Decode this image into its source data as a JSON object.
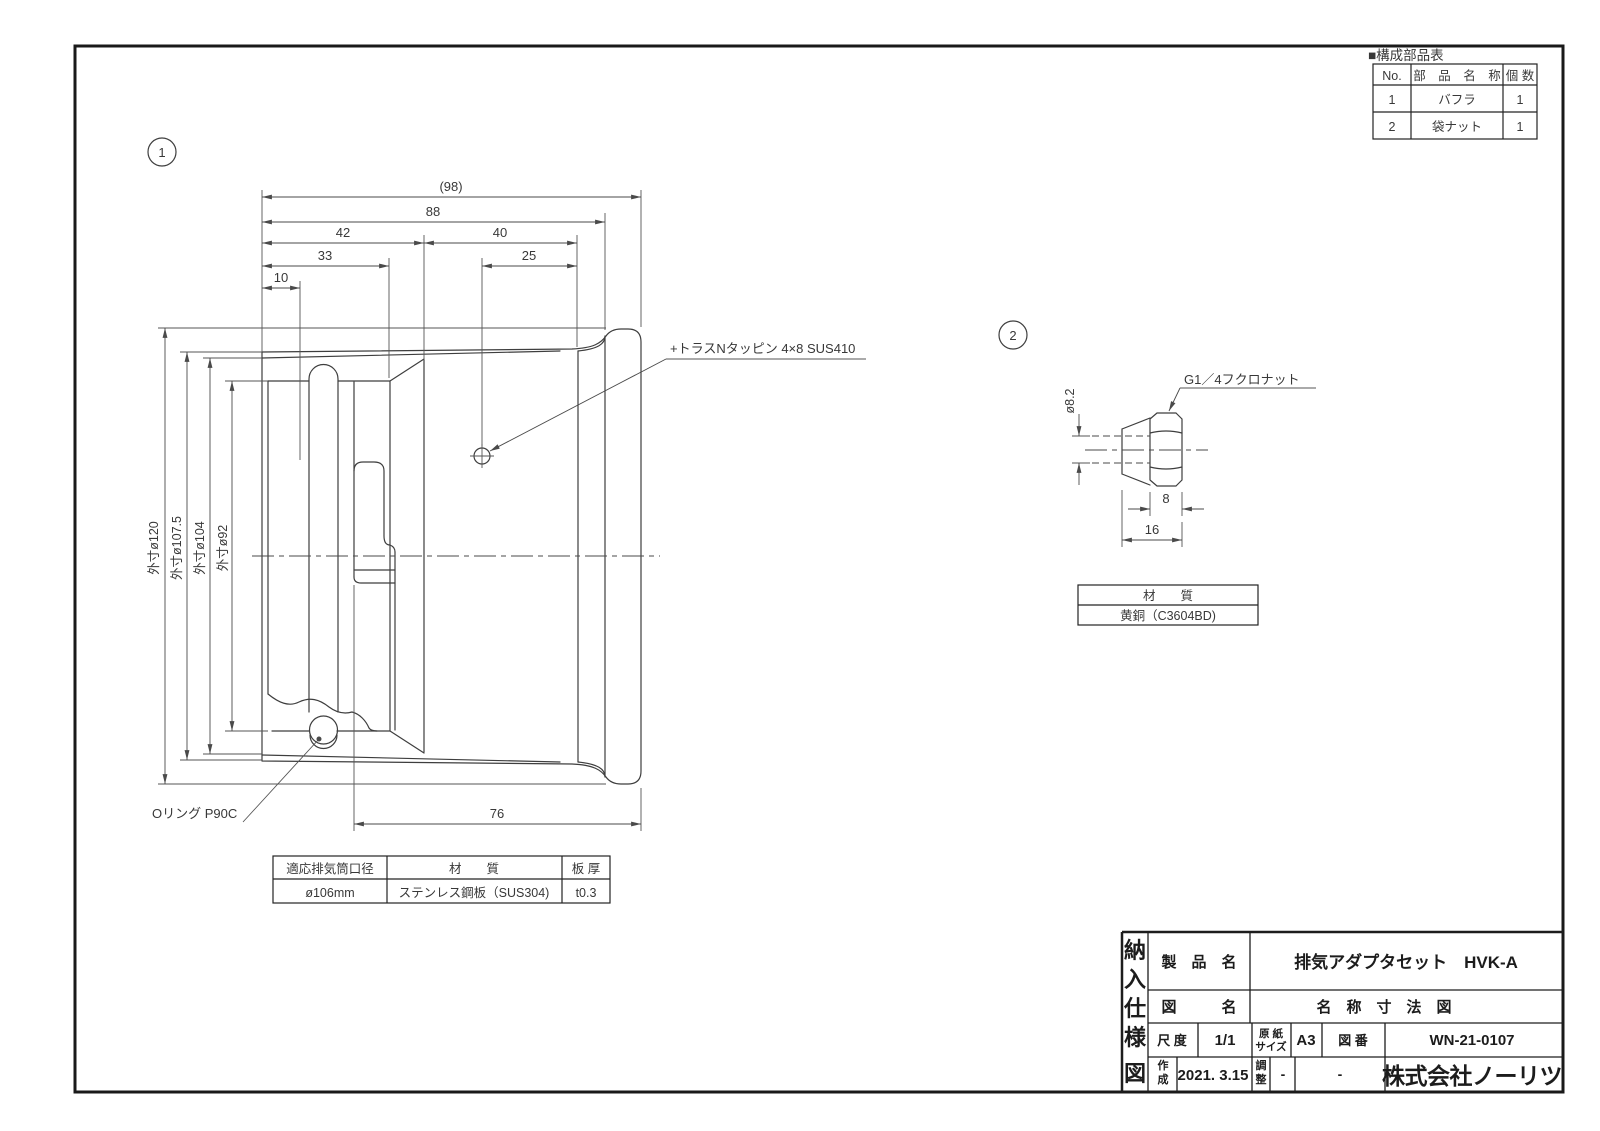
{
  "parts_table": {
    "title": "■構成部品表",
    "col_no": "No.",
    "col_name": "部　品　名　称",
    "col_qty": "個 数",
    "rows": [
      {
        "no": "1",
        "name": "バフラ",
        "qty": "1"
      },
      {
        "no": "2",
        "name": "袋ナット",
        "qty": "1"
      }
    ]
  },
  "view1": {
    "balloon": "1",
    "dim_98": "(98)",
    "dim_88": "88",
    "dim_42": "42",
    "dim_40": "40",
    "dim_33": "33",
    "dim_25": "25",
    "dim_10": "10",
    "dim_76": "76",
    "dia_120": "外寸ø120",
    "dia_1075": "外寸ø107.5",
    "dia_104": "外寸ø104",
    "dia_92": "外寸ø92",
    "screw_callout": "+トラスNタッピン 4×8 SUS410",
    "oring_callout": "Oリング P90C",
    "table": {
      "h_bore": "適応排気筒口径",
      "h_material": "材　　質",
      "h_thickness": "板 厚",
      "v_bore": "ø106mm",
      "v_material": "ステンレス鋼板（SUS304)",
      "v_thickness": "t0.3"
    }
  },
  "view2": {
    "balloon": "2",
    "callout": "G1／4フクロナット",
    "dim_dia": "ø8.2",
    "dim_8": "8",
    "dim_16": "16",
    "table": {
      "h_material": "材　　質",
      "v_material": "黄銅（C3604BD)"
    }
  },
  "title_block": {
    "side_label": [
      "納",
      "入",
      "仕",
      "様",
      "図"
    ],
    "product_label": "製　品　名",
    "product_value": "排気アダプタセット　HVK-A",
    "drawing_label": "図　　　名",
    "drawing_value": "名　称　寸　法　図",
    "scale_label": "尺 度",
    "scale_value": "1/1",
    "paper_label": [
      "原 紙",
      "サイズ"
    ],
    "paper_value": "A3",
    "number_label": "図 番",
    "number_value": "WN-21-0107",
    "created_label": [
      "作",
      "成"
    ],
    "created_value": "2021. 3.15",
    "adjusted_label": [
      "調",
      "整"
    ],
    "adjusted_value": "-",
    "extra_value": "-",
    "company": "株式会社ノーリツ"
  }
}
